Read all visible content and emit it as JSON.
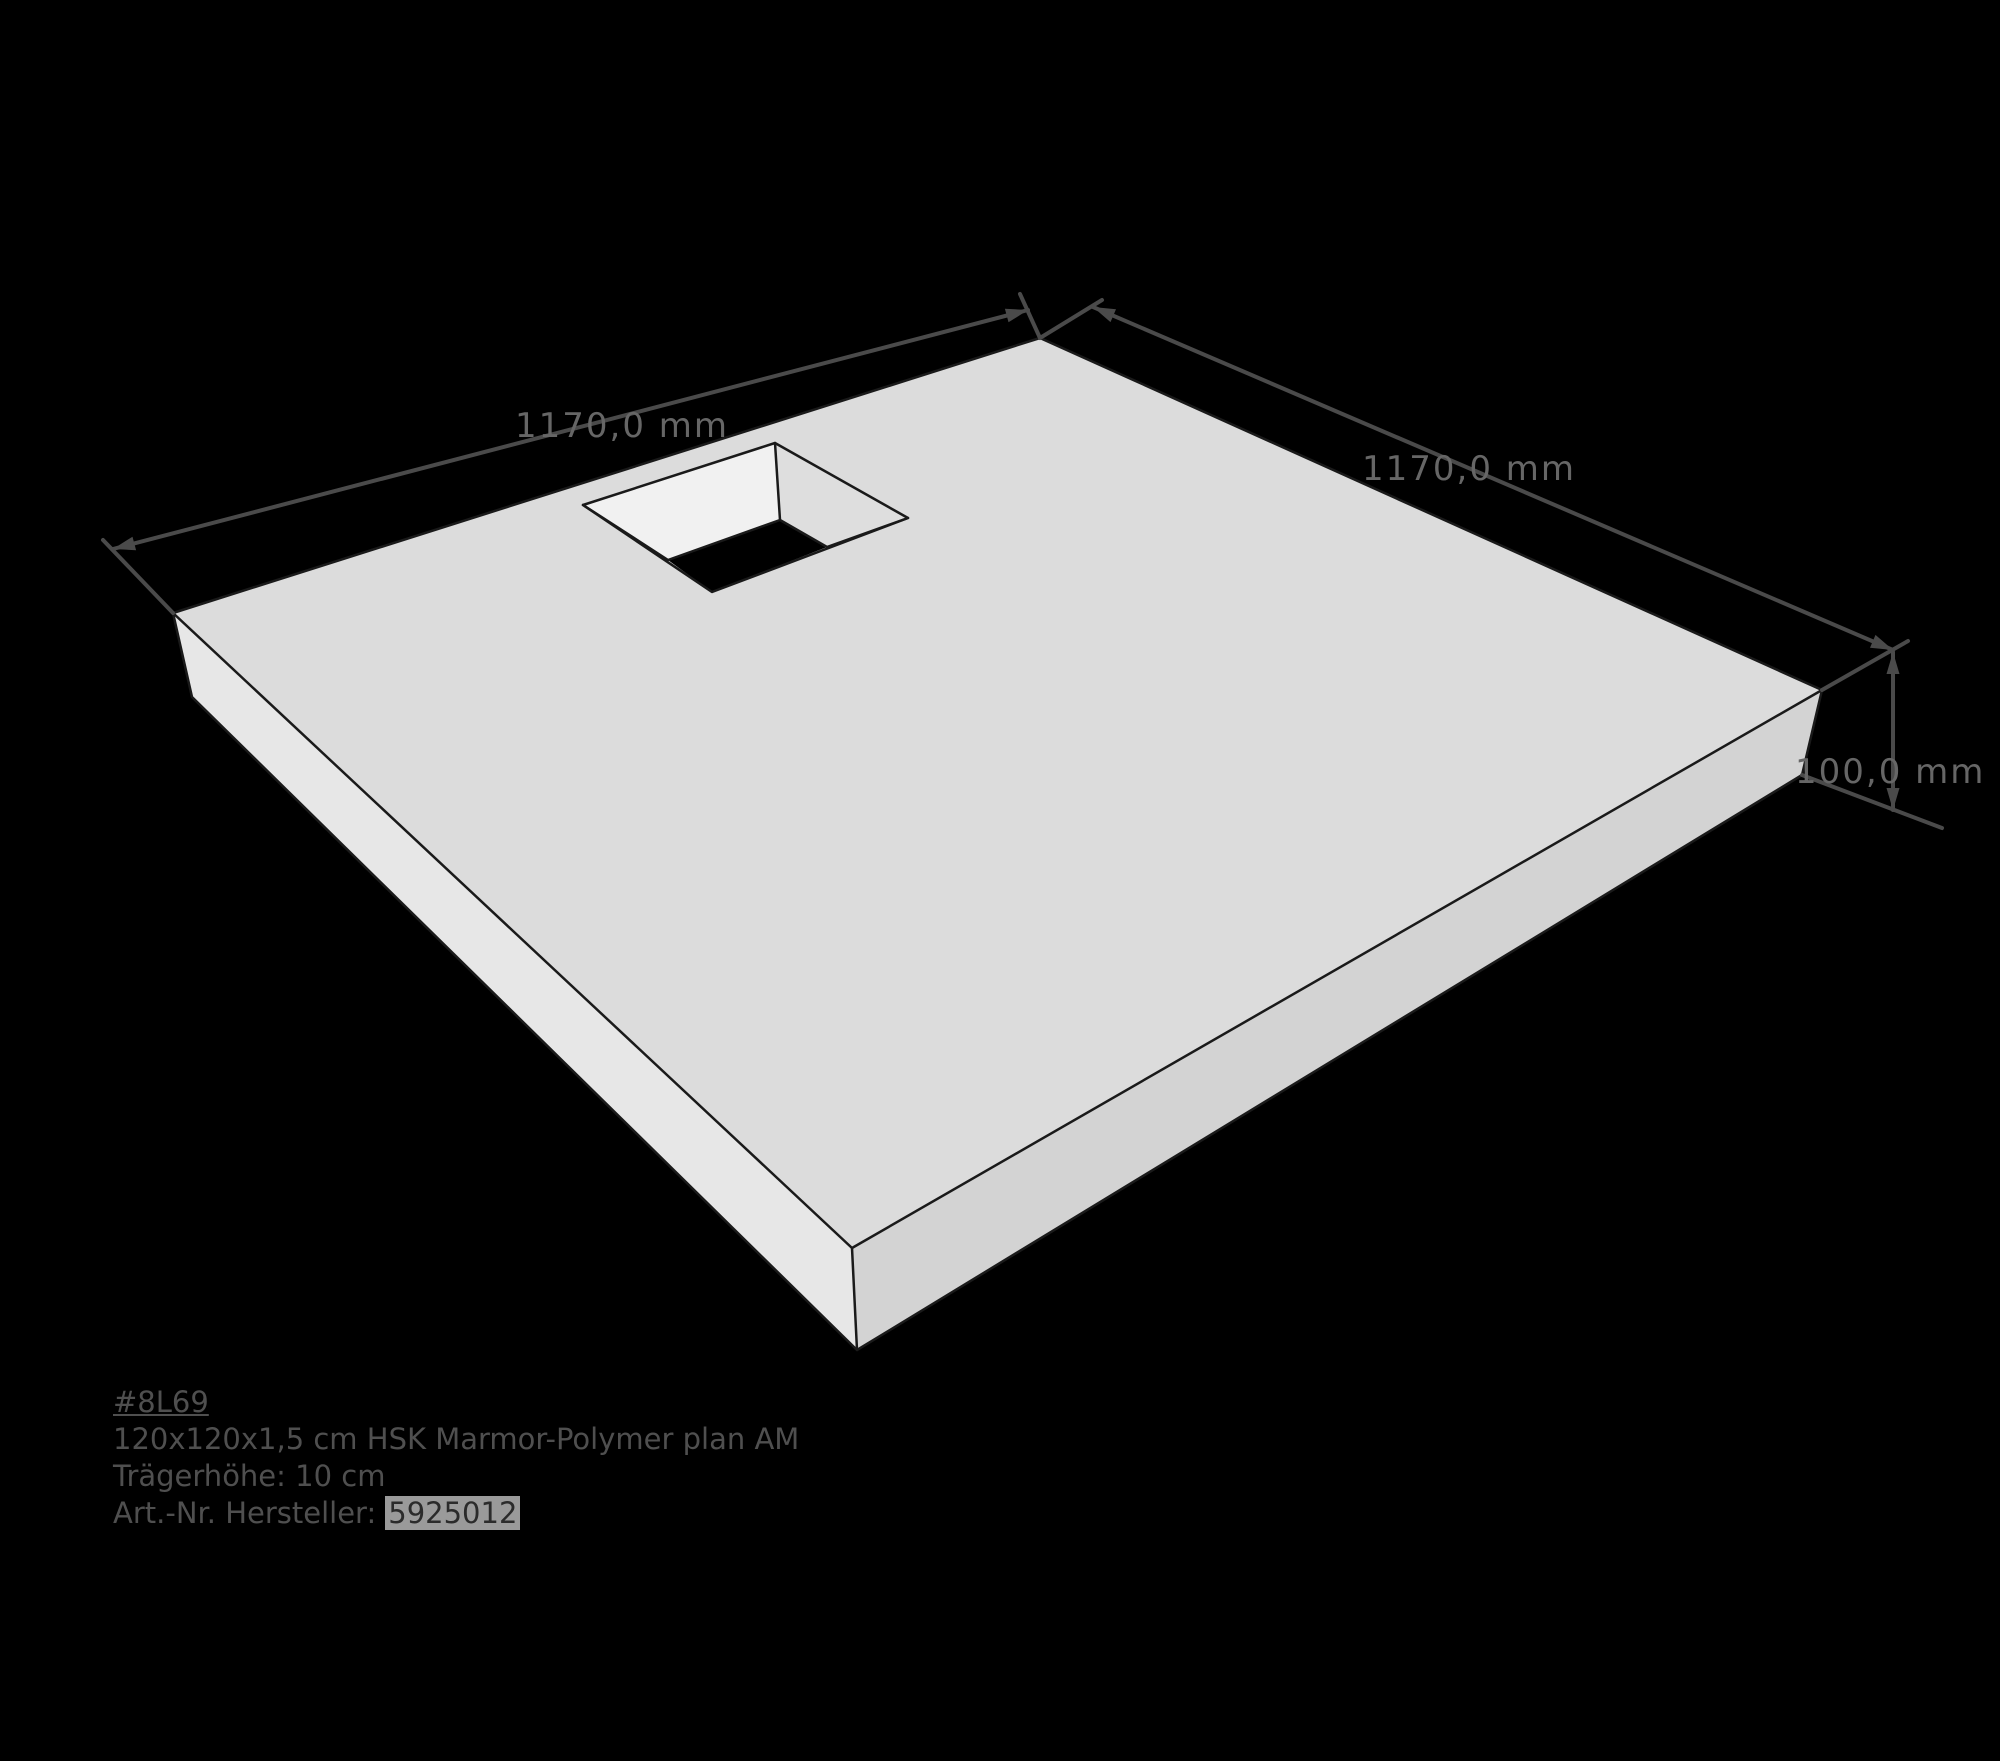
{
  "labels": {
    "width": "1170,0 mm",
    "depth": "1170,0 mm",
    "height": "100,0 mm"
  },
  "product_info": {
    "id": "#8L69",
    "description": "120x120x1,5 cm HSK Marmor-Polymer plan AM",
    "carrier_height": "Trägerhöhe: 10 cm",
    "article_label": "Art.-Nr. Hersteller:",
    "article_value": "5925012"
  },
  "colors": {
    "background": "#000000",
    "top_face": "#dcdcdc",
    "left_face": "#e7e7e7",
    "right_face": "#d3d3d3",
    "cutout_left_wall": "#f1f1f1",
    "cutout_right_wall": "#dedede",
    "drain_hole": "#000000",
    "edge": "#1a1a1a",
    "dimension_line": "#4a4a4a",
    "dimension_text": "#666666",
    "info_text": "#4f4f4f",
    "highlight_bg": "#9a9a9a",
    "highlight_text": "#2b2b2b"
  }
}
